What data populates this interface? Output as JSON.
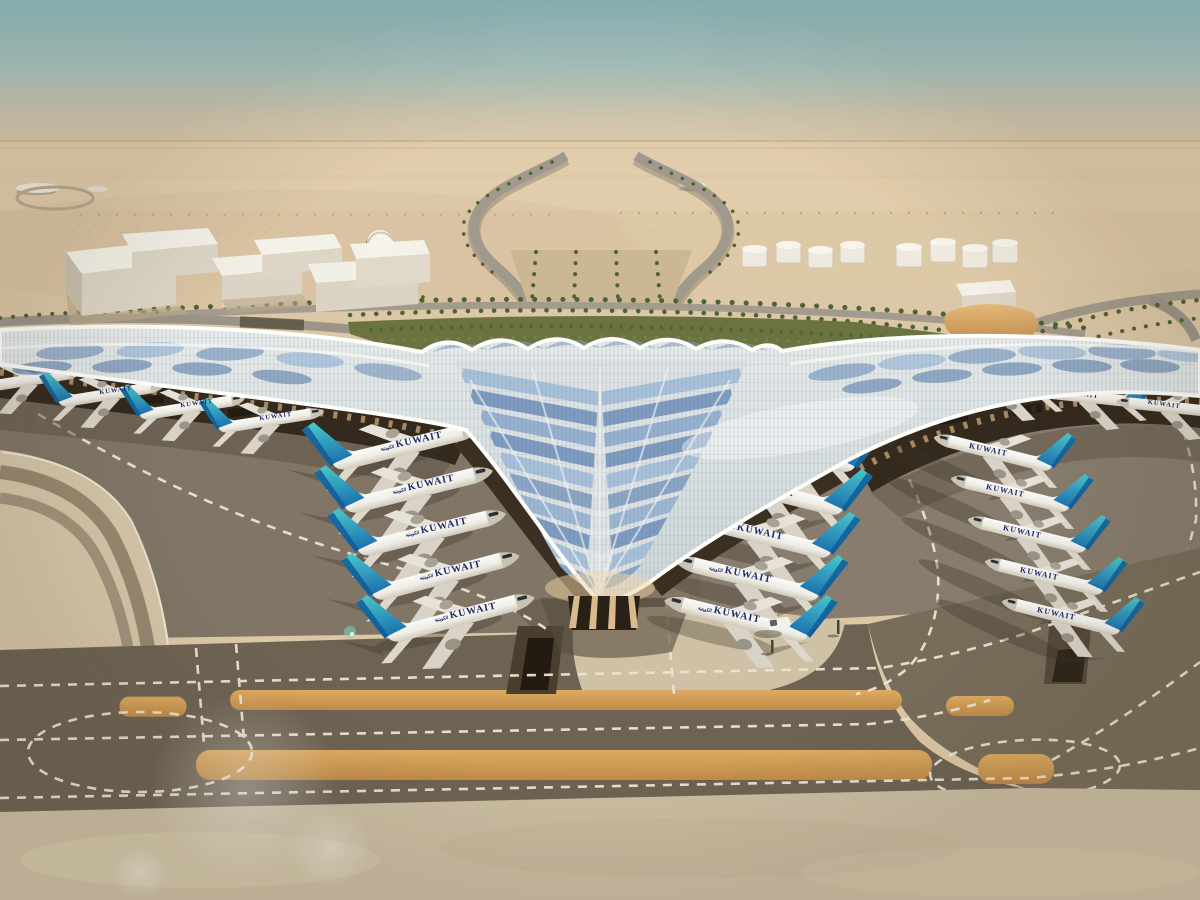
{
  "scene": {
    "subject": "Aerial rendering of a desert airport terminal with trefoil roof",
    "sky": "hazy teal fading to sand haze"
  },
  "aircraft": {
    "airline_title": "KUWAIT",
    "airline_title_arabic": "الكويتية",
    "counts": {
      "left_concourse_row": 5,
      "left_wing_row": 4,
      "right_concourse_row": 5,
      "right_outer_row": 5,
      "right_wing_row": 3
    },
    "ground_vehicles": 1
  },
  "palette": {
    "sky_top": "#8cbac0",
    "sky_haze": "#dcc8ae",
    "desert_sand": "#dcc7a6",
    "foreground_sand": "#cabda2",
    "corner_sand": "#d5c5a8",
    "apron": "#817566",
    "taxiway_dark": "#6e6353",
    "taxiway_diagonal": "#786d5b",
    "shoulder_orange": "#cf9a54",
    "dash_white": "#ece5d2",
    "roof_pale": "#dfe4e6",
    "roof_blue": "#7e9cc2",
    "roof_blue_light": "#a9c2dc",
    "under_roof": "#33291d",
    "facade_tan": "#cfa87b",
    "landscape_green": "#6b7340",
    "road_gray": "#a09a8e",
    "building_white": "#f3f0e7",
    "tail_teal": "#3bbec4",
    "tail_blue": "#1568a6",
    "fuselage_white": "#f6f4ef",
    "title_navy": "#1d2a66"
  }
}
